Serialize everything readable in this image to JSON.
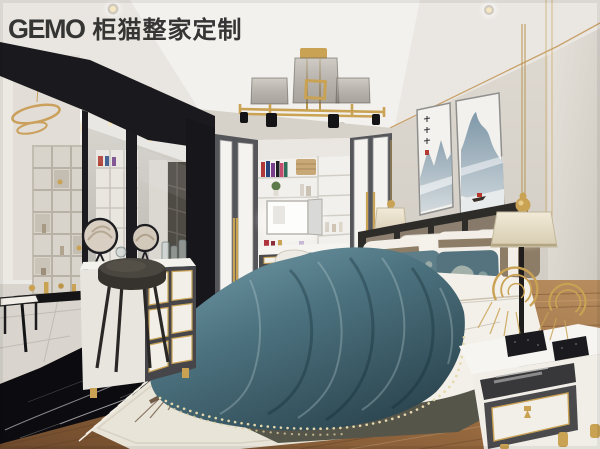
{
  "watermark": {
    "brand": "GEMO",
    "name": "柜猫整家定制"
  },
  "palette": {
    "wall": "#d8d3cb",
    "ceiling": "#f0eeea",
    "cove_light": "#fdf6e4",
    "gold_accent": "#c9a254",
    "charcoal_panel": "#1a1a1e",
    "wardrobe_stile": "#55565a",
    "teal_velvet": "#4d7380",
    "headboard_taupe": "#8d8070",
    "wood_floor": "#95683f",
    "black_marble": "#0c0c10",
    "rug": "#e9e4d8",
    "bed_base_olive": "#56554a"
  },
  "scene": {
    "description": "bedroom-interior-rendering",
    "objects": [
      "ceiling-chandelier",
      "cove-lighting",
      "recessed-spotlight",
      "ring-pendant-light",
      "display-shelf",
      "console-desk",
      "side-table",
      "mirror-cabinet",
      "dresser",
      "stool",
      "wardrobe",
      "vanity-mirror",
      "vanity-chair",
      "wall-art-ink-landscape",
      "bedside-pendant-lamp",
      "bed",
      "pillows",
      "teal-runner",
      "nightstand",
      "gold-swirl-sculpture",
      "area-rug",
      "wood-floor",
      "black-marble-floor"
    ]
  }
}
